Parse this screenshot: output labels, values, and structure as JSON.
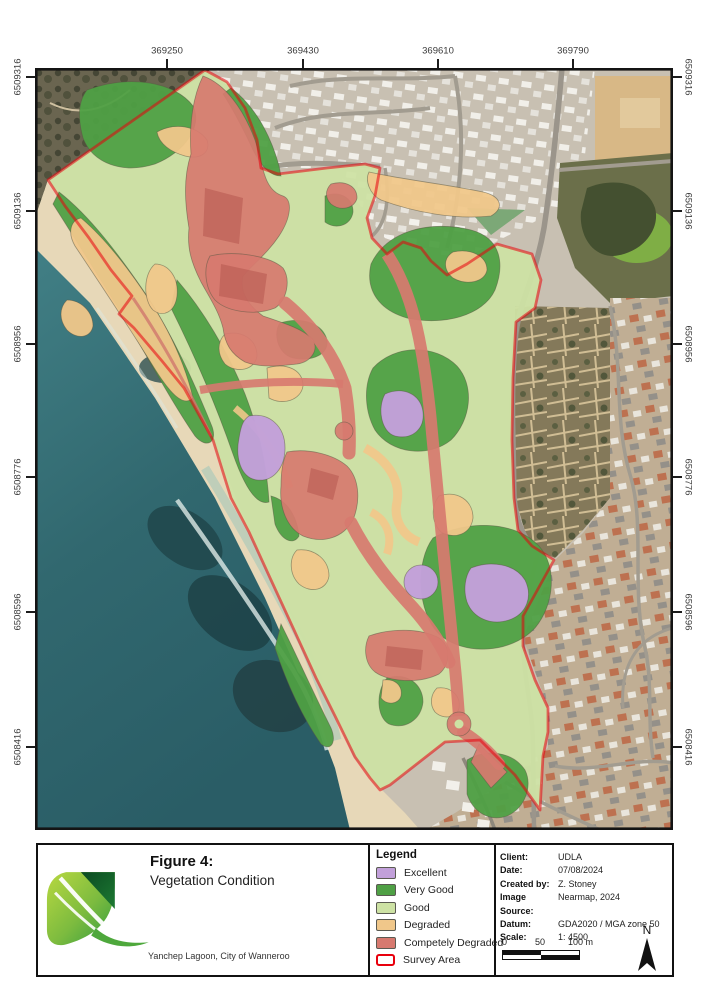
{
  "figure": {
    "label": "Figure 4:",
    "title": "Vegetation Condition",
    "project": "Yanchep Lagoon, City of Wanneroo"
  },
  "map": {
    "top_coordinates": [
      "369250",
      "369430",
      "369610",
      "369790"
    ],
    "side_coordinates": [
      "6509316",
      "6509136",
      "6508956",
      "6508776",
      "6508596",
      "6508416"
    ]
  },
  "legend": {
    "title": "Legend",
    "items": [
      {
        "label": "Excellent",
        "color": "#c2a0da"
      },
      {
        "label": "Very Good",
        "color": "#4fa045"
      },
      {
        "label": "Good",
        "color": "#cde2a4"
      },
      {
        "label": "Degraded",
        "color": "#f0c78a"
      },
      {
        "label": "Competely Degraded",
        "color": "#d7796f"
      },
      {
        "label": "Survey Area",
        "color": "#e8000d"
      }
    ]
  },
  "metadata": {
    "rows": [
      {
        "label": "Client:",
        "value": "UDLA"
      },
      {
        "label": "Date:",
        "value": "07/08/2024"
      },
      {
        "label": "Created by:",
        "value": "Z. Stoney"
      },
      {
        "label": "Image Source:",
        "value": "Nearmap, 2024"
      },
      {
        "label": "Datum:",
        "value": "GDA2020 / MGA zone 50"
      },
      {
        "label": "Scale:",
        "value": "1: 4500"
      }
    ]
  },
  "scale_bar": {
    "labels": [
      "0",
      "50",
      "100 m"
    ]
  },
  "north_arrow": {
    "label": "N"
  }
}
